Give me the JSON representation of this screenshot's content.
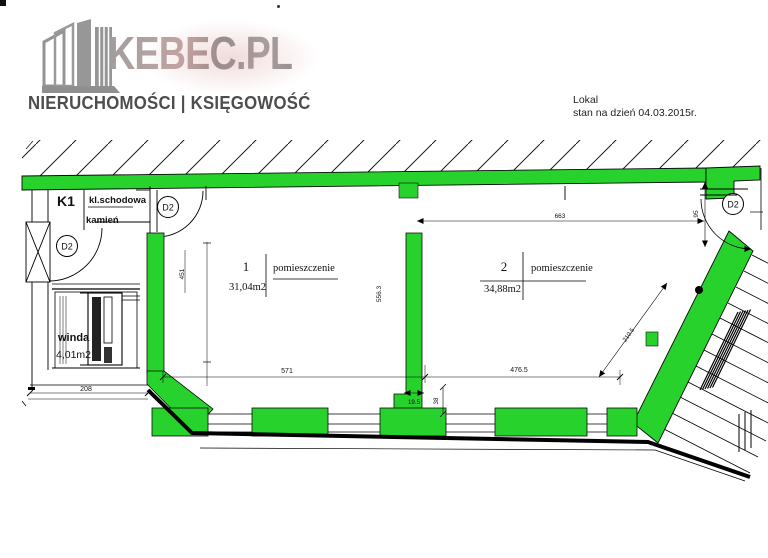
{
  "header": {
    "brand": "KEBEC.PL",
    "brand_tm": "TM",
    "tagline": "NIERUCHOMOŚCI | KSIĘGOWOŚĆ"
  },
  "note": {
    "line1": "Lokal",
    "line2": "stan na dzień 04.03.2015r."
  },
  "plan": {
    "stairwell": {
      "code": "K1",
      "name": "kl.schodowa",
      "material": "kamień"
    },
    "elevator": {
      "name": "winda",
      "area": "4,01m2"
    },
    "room1": {
      "number": "1",
      "type": "pomieszczenie",
      "area": "31,04m2"
    },
    "room2": {
      "number": "2",
      "type": "pomieszczenie",
      "area": "34,88m2"
    },
    "door_label": "D2",
    "dims": {
      "w1": "571",
      "w2": "476.5",
      "top": "663",
      "door": "95",
      "diag": "210.5",
      "v1": "451",
      "v2": "556.3",
      "s1": "19.5",
      "s2": "38",
      "elev": "208"
    }
  },
  "colors": {
    "wall_green": "#28d22c",
    "line": "#000000"
  }
}
